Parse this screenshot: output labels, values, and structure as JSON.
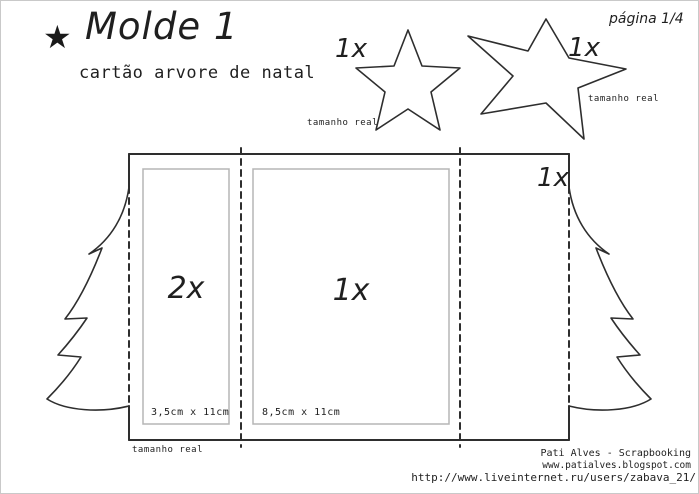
{
  "header": {
    "star_icon": "★",
    "title": "Molde 1",
    "subtitle": "cartão arvore de natal",
    "page_label": "página 1/4"
  },
  "stars": {
    "small": {
      "count": "1x",
      "caption": "tamanho real"
    },
    "large": {
      "count": "1x",
      "caption": "tamanho real"
    }
  },
  "template": {
    "left_panel": {
      "count": "2x",
      "size": "3,5cm x 11cm"
    },
    "middle_panel": {
      "count": "1x",
      "size": "8,5cm x 11cm"
    },
    "right_panel": {
      "count": "1x"
    },
    "caption": "tamanho real"
  },
  "footer": {
    "credit_name": "Pati Alves - Scrapbooking",
    "credit_site": "www.patialves.blogspot.com",
    "watermark": "http://www.liveinternet.ru/users/zabava_21/"
  },
  "colors": {
    "line": "#2e2e2e",
    "panel_outline": "#b5b5b5",
    "frame": "#c9c9c9",
    "text": "#1f1f1f"
  }
}
